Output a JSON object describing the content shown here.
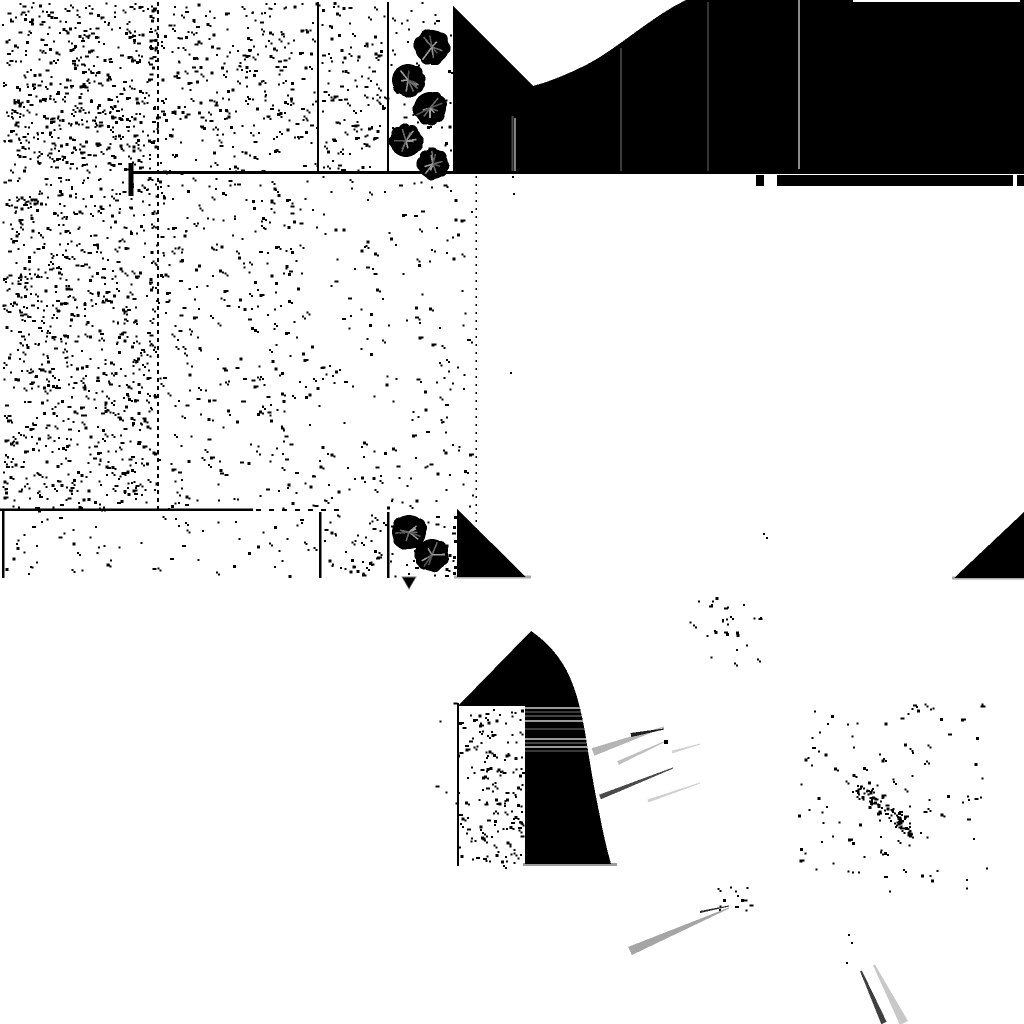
{
  "canvas": {
    "width": 1024,
    "height": 1024,
    "background": "#ffffff"
  },
  "palette": {
    "ink": "#000000",
    "paper": "#ffffff",
    "gray_underline": "#a9a9a9",
    "gray_light_streak": "#b4b4b4",
    "gray_lighter_streak": "#d2d2d2",
    "gray_mid_streak": "#a5a5a5",
    "gray_dark_streak": "#4a4a4a",
    "gray_hairline": "#8c8c8c"
  },
  "noise_regions": [
    {
      "x": 2,
      "y": 2,
      "w": 155,
      "h": 170,
      "d": 0.02,
      "seed": 1
    },
    {
      "x": 160,
      "y": 2,
      "w": 156,
      "h": 170,
      "d": 0.011,
      "seed": 2
    },
    {
      "x": 321,
      "y": 2,
      "w": 65,
      "h": 170,
      "d": 0.011,
      "seed": 3
    },
    {
      "x": 390,
      "y": 2,
      "w": 62,
      "h": 170,
      "d": 0.005,
      "seed": 4
    },
    {
      "x": 2,
      "y": 176,
      "w": 154,
      "h": 334,
      "d": 0.016,
      "seed": 5
    },
    {
      "x": 159,
      "y": 176,
      "w": 158,
      "h": 334,
      "d": 0.006,
      "seed": 6
    },
    {
      "x": 318,
      "y": 176,
      "w": 156,
      "h": 334,
      "d": 0.0035,
      "seed": 7
    },
    {
      "x": 5,
      "y": 515,
      "w": 312,
      "h": 60,
      "d": 0.0035,
      "seed": 8
    },
    {
      "x": 323,
      "y": 514,
      "w": 63,
      "h": 62,
      "d": 0.011,
      "seed": 9
    },
    {
      "x": 390,
      "y": 514,
      "w": 63,
      "h": 62,
      "d": 0.006,
      "seed": 10
    },
    {
      "x": 432,
      "y": 700,
      "w": 90,
      "h": 166,
      "d": 0.011,
      "seed": 11,
      "biasRight": true
    },
    {
      "x": 688,
      "y": 595,
      "w": 85,
      "h": 70,
      "d": 0.005,
      "seed": 12
    },
    {
      "x": 798,
      "y": 703,
      "w": 192,
      "h": 188,
      "d": 0.0032,
      "seed": 13
    },
    {
      "x": 856,
      "y": 786,
      "w": 58,
      "h": 52,
      "d": 0.028,
      "seed": 14,
      "diag": true
    },
    {
      "x": 714,
      "y": 880,
      "w": 36,
      "h": 32,
      "d": 0.01,
      "seed": 15
    }
  ],
  "structure_lines": {
    "vertical": [
      {
        "x": 158,
        "y1": 2,
        "y2": 510,
        "w": 2,
        "dash": "4,4"
      },
      {
        "x": 318,
        "y1": 2,
        "y2": 172,
        "w": 2
      },
      {
        "x": 388,
        "y1": 2,
        "y2": 172,
        "w": 2
      },
      {
        "x": 3,
        "y1": 511,
        "y2": 578,
        "w": 2.5
      },
      {
        "x": 320,
        "y1": 512,
        "y2": 578,
        "w": 2.5
      },
      {
        "x": 388,
        "y1": 512,
        "y2": 578,
        "w": 2.5
      },
      {
        "x": 476,
        "y1": 176,
        "y2": 580,
        "w": 1.5,
        "dash": "2,6"
      },
      {
        "x": 458,
        "y1": 703,
        "y2": 866,
        "w": 2
      },
      {
        "x": 131,
        "y1": 163,
        "y2": 196,
        "w": 5
      }
    ],
    "horizontal": [
      {
        "y": 509.5,
        "x1": 0,
        "x2": 253,
        "w": 2.5
      },
      {
        "y": 510,
        "x1": 256,
        "x2": 340,
        "w": 2,
        "dash": "5,8"
      },
      {
        "y": 577,
        "x1": 454,
        "x2": 531,
        "w": 3,
        "c": "#a9a9a9"
      },
      {
        "y": 578,
        "x1": 952,
        "x2": 1024,
        "w": 3,
        "c": "#a9a9a9"
      },
      {
        "y": 864.5,
        "x1": 523,
        "x2": 617,
        "w": 3,
        "c": "#9c9c9c"
      }
    ]
  },
  "dark_mass": {
    "path": "M453,6 L453,172 L1024,172 L1024,0 L686,0 C652,16 616,50 586,65 C568,74 549,82 533,86 Z",
    "hairlines": [
      {
        "x": 512.5,
        "y1": 116,
        "y2": 172,
        "w": 2,
        "c": "#4a4a4a"
      },
      {
        "x": 515,
        "y1": 118,
        "y2": 172,
        "w": 1,
        "c": "#ffffff"
      },
      {
        "x": 621,
        "y1": 48,
        "y2": 172,
        "w": 2,
        "c": "#3d3d3d"
      },
      {
        "x": 708,
        "y1": 2,
        "y2": 172,
        "w": 2,
        "c": "#343434"
      },
      {
        "x": 799,
        "y1": 0,
        "y2": 169,
        "w": 2,
        "c": "#8c8c8c"
      }
    ],
    "top_sliver": {
      "y": 1,
      "x1": 853,
      "x2": 1020,
      "w": 2,
      "c": "#ffffff"
    },
    "bottom_line": {
      "y": 172.5,
      "x1": 130,
      "x2": 1024,
      "w": 3,
      "c": "#000000"
    },
    "band_rects": [
      {
        "x": 756,
        "y": 175,
        "w": 8,
        "h": 11
      },
      {
        "x": 777,
        "y": 175,
        "w": 236,
        "h": 11
      },
      {
        "x": 1017,
        "y": 175,
        "w": 7,
        "h": 11
      }
    ]
  },
  "trees": [
    {
      "cx": 432,
      "cy": 47,
      "r": 17
    },
    {
      "cx": 408,
      "cy": 80,
      "r": 16
    },
    {
      "cx": 430,
      "cy": 108,
      "r": 16
    },
    {
      "cx": 406,
      "cy": 141,
      "r": 16
    },
    {
      "cx": 433,
      "cy": 164,
      "r": 15
    },
    {
      "cx": 409,
      "cy": 532,
      "r": 17
    },
    {
      "cx": 432,
      "cy": 555,
      "r": 16
    }
  ],
  "shadow_triangles": [
    {
      "points": "457,509 457,577 526,577"
    },
    {
      "points": "954,578 1024,512 1024,578"
    }
  ],
  "arch": {
    "path": "M531,631 C549,643 565,662 573,685 C579,701 582,716 585,732 C589,757 593,783 598,807 C602,827 606,847 611,864 L525,864 L525,706 L458,706 Z",
    "stripes": {
      "x1": 516,
      "x2": 593,
      "lines": [
        {
          "y": 708,
          "w": 2,
          "c": "#9a9a9a"
        },
        {
          "y": 712,
          "w": 1,
          "c": "#6e6e6e"
        },
        {
          "y": 716,
          "w": 1,
          "c": "#8a8a8a"
        },
        {
          "y": 721,
          "w": 2,
          "c": "#9a9a9a"
        },
        {
          "y": 729,
          "w": 1,
          "c": "#7a7a7a"
        },
        {
          "y": 739,
          "w": 2,
          "c": "#9a9a9a"
        },
        {
          "y": 743,
          "w": 1,
          "c": "#8a8a8a"
        },
        {
          "y": 747,
          "w": 2,
          "c": "#9a9a9a"
        },
        {
          "y": 751,
          "w": 1,
          "c": "#6e6e6e"
        }
      ]
    }
  },
  "streaks": [
    {
      "x1": 593,
      "y1": 752,
      "x2": 664,
      "y2": 727,
      "w1": 8,
      "w2": 1,
      "c": "#b4b4b4"
    },
    {
      "x1": 631,
      "y1": 735,
      "x2": 664,
      "y2": 729,
      "w1": 4,
      "w2": 1,
      "c": "#1e1e1e"
    },
    {
      "x1": 618,
      "y1": 763,
      "x2": 666,
      "y2": 741,
      "w1": 4,
      "w2": 1,
      "c": "#bebebe"
    },
    {
      "x1": 672,
      "y1": 752,
      "x2": 700,
      "y2": 744,
      "w1": 3,
      "w2": 1,
      "c": "#d2d2d2"
    },
    {
      "x1": 600,
      "y1": 797,
      "x2": 673,
      "y2": 768,
      "w1": 5,
      "w2": 1,
      "c": "#4a4a4a"
    },
    {
      "x1": 648,
      "y1": 801,
      "x2": 700,
      "y2": 783,
      "w1": 3,
      "w2": 1,
      "c": "#cfcfcf"
    },
    {
      "x1": 630,
      "y1": 951,
      "x2": 729,
      "y2": 908,
      "w1": 9,
      "w2": 1,
      "c": "#a5a5a5"
    },
    {
      "x1": 700,
      "y1": 912,
      "x2": 729,
      "y2": 906,
      "w1": 2,
      "w2": 1,
      "c": "#2e2e2e"
    },
    {
      "x1": 884,
      "y1": 1023,
      "x2": 861,
      "y2": 971,
      "w1": 6,
      "w2": 2,
      "c": "#3f3f3f"
    },
    {
      "x1": 904,
      "y1": 1023,
      "x2": 874,
      "y2": 965,
      "w1": 9,
      "w2": 2,
      "c": "#c8c8c8"
    }
  ],
  "stray_dots": {
    "points": [
      [
        510,
        372,
        2
      ],
      [
        512,
        176,
        2
      ],
      [
        513,
        193,
        2
      ],
      [
        763,
        533,
        2
      ],
      [
        766,
        537,
        2
      ],
      [
        848,
        934,
        2
      ],
      [
        851,
        942,
        2
      ],
      [
        846,
        962,
        2
      ],
      [
        737,
        895,
        2
      ],
      [
        664,
        740,
        4
      ],
      [
        454,
        516,
        3
      ],
      [
        453,
        526,
        3
      ],
      [
        454,
        540,
        3
      ],
      [
        453,
        556,
        3
      ],
      [
        454,
        566,
        3
      ],
      [
        453,
        572,
        3
      ],
      [
        408,
        573,
        2
      ],
      [
        413,
        560,
        2
      ]
    ]
  },
  "arrow_mark": {
    "points": "402,577 416,577 409,589"
  }
}
